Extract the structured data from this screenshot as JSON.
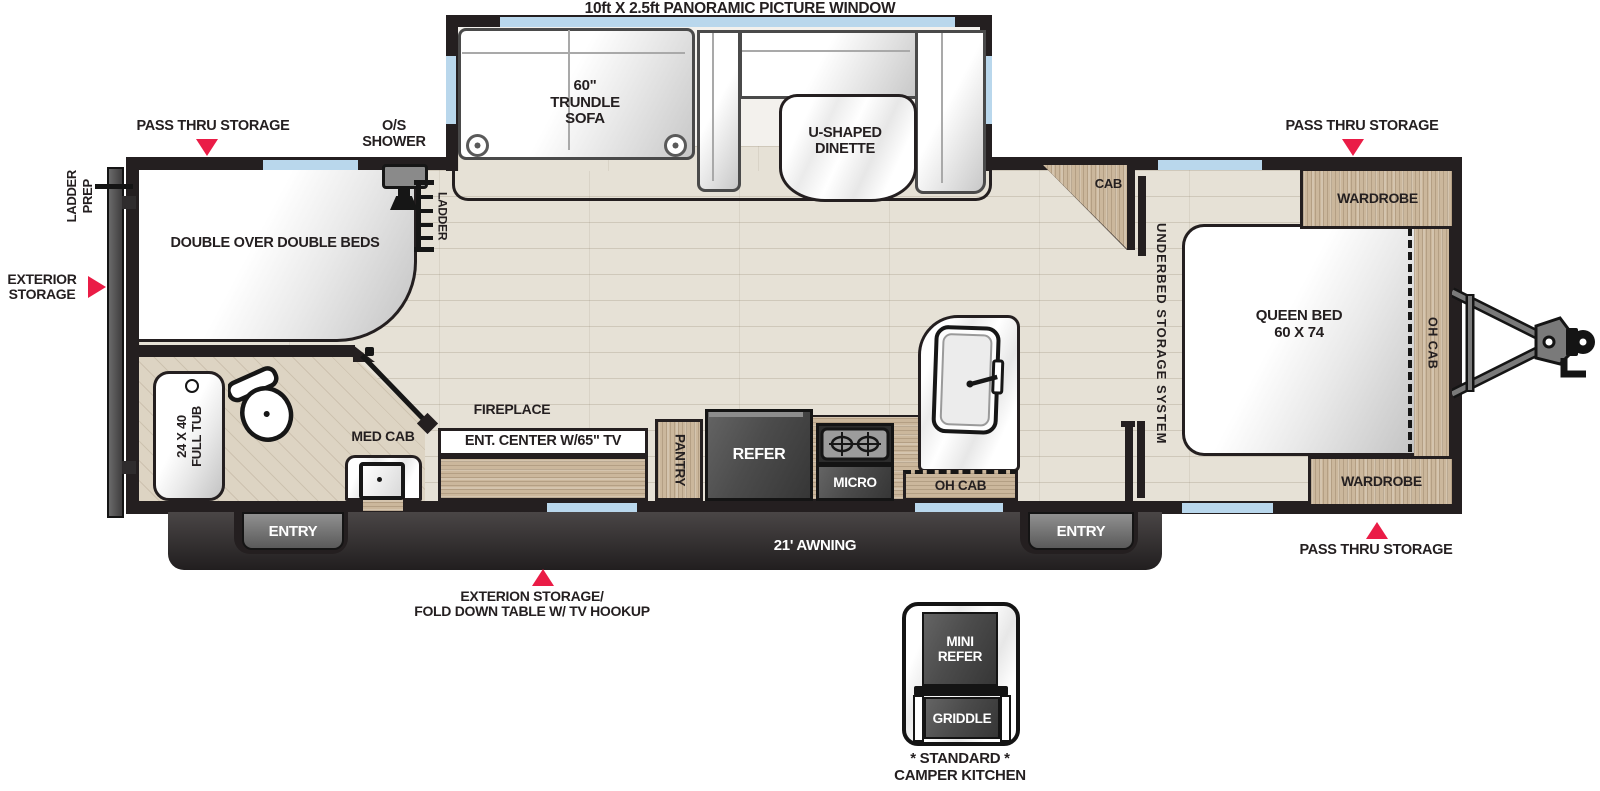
{
  "colors": {
    "accent_red": "#ea1c46",
    "wall": "#241f20",
    "wood": "#cbb79c",
    "floor": "#e6e1d6",
    "window_blue": "#b9d7ec"
  },
  "top_callout": {
    "label": "10ft X 2.5ft PANORAMIC PICTURE WINDOW"
  },
  "slideout": {
    "sofa": {
      "line1": "60\"",
      "line2": "TRUNDLE",
      "line3": "SOFA"
    },
    "dinette": {
      "line1": "U-SHAPED",
      "line2": "DINETTE"
    }
  },
  "callouts": {
    "pass_thru_left": "PASS THRU STORAGE",
    "pass_thru_right_top": "PASS THRU STORAGE",
    "pass_thru_right_bottom": "PASS THRU STORAGE",
    "os_shower": {
      "line1": "O/S",
      "line2": "SHOWER"
    },
    "ladder_prep": {
      "line1": "LADDER",
      "line2": "PREP"
    },
    "exterior_storage": {
      "line1": "EXTERIOR",
      "line2": "STORAGE"
    },
    "fold_down": {
      "line1": "EXTERION STORAGE/",
      "line2": "FOLD DOWN TABLE W/ TV HOOKUP"
    }
  },
  "exterior": {
    "awning": "21' AWNING",
    "entry_left": "ENTRY",
    "entry_right": "ENTRY"
  },
  "bunk_room": {
    "beds": "DOUBLE OVER DOUBLE BEDS",
    "ladder": "LADDER",
    "tub": {
      "line1": "24 X 40",
      "line2": "FULL TUB"
    },
    "med_cab": "MED CAB"
  },
  "living": {
    "fireplace": "FIREPLACE",
    "ent_center": "ENT. CENTER W/65\" TV",
    "pantry": "PANTRY",
    "refer": "REFER",
    "micro": "MICRO",
    "oh_cab": "OH CAB"
  },
  "bedroom": {
    "cab": "CAB",
    "underbed": "UNDERBED STORAGE SYSTEM",
    "wardrobe_top": "WARDROBE",
    "wardrobe_bottom": "WARDROBE",
    "queen": {
      "line1": "QUEEN BED",
      "line2": "60 X 74"
    },
    "oh_cab": "OH CAB"
  },
  "camper_kitchen": {
    "mini_refer": {
      "line1": "MINI",
      "line2": "REFER"
    },
    "griddle": "GRIDDLE",
    "caption": {
      "line1": "* STANDARD *",
      "line2": "CAMPER KITCHEN"
    }
  }
}
